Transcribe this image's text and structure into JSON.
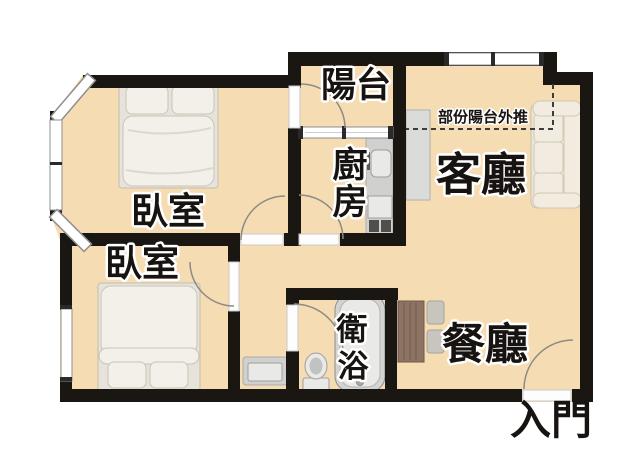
{
  "rooms": {
    "bedroom_top": {
      "label": "臥室"
    },
    "bedroom_bottom": {
      "label": "臥室"
    },
    "balcony": {
      "label": "陽台"
    },
    "kitchen": {
      "chars": [
        "廚",
        "房"
      ]
    },
    "living_room": {
      "label": "客廳"
    },
    "bathroom": {
      "chars": [
        "衛",
        "浴"
      ]
    },
    "dining_room": {
      "label": "餐廳"
    }
  },
  "annotations": {
    "balcony_extension_note": "部份陽台外推",
    "entrance_label": "入門"
  },
  "colors": {
    "background": "#ffffff",
    "floor": "#f6dcb2",
    "wall": "#1a1713",
    "window_fill": "#ffffff",
    "window_frame": "#8f8f8f",
    "window_tick": "#2a2a2a",
    "door_opening": "#fdfdfd",
    "door_arc": "#8b8b87",
    "dashed_line": "#3c3c3c",
    "label_ink": "#171310",
    "label_halo": "#ffffff",
    "bed_linen": "#f3f0e9",
    "sofa_fabric": "#ebe6d8",
    "cabinet_gray": "#dbdbd9",
    "counter_gray": "#d0d0ce",
    "table_wood": "#8d7363",
    "chair_gray": "#c8c5bf",
    "fixture_gray": "#e9e9e7"
  }
}
